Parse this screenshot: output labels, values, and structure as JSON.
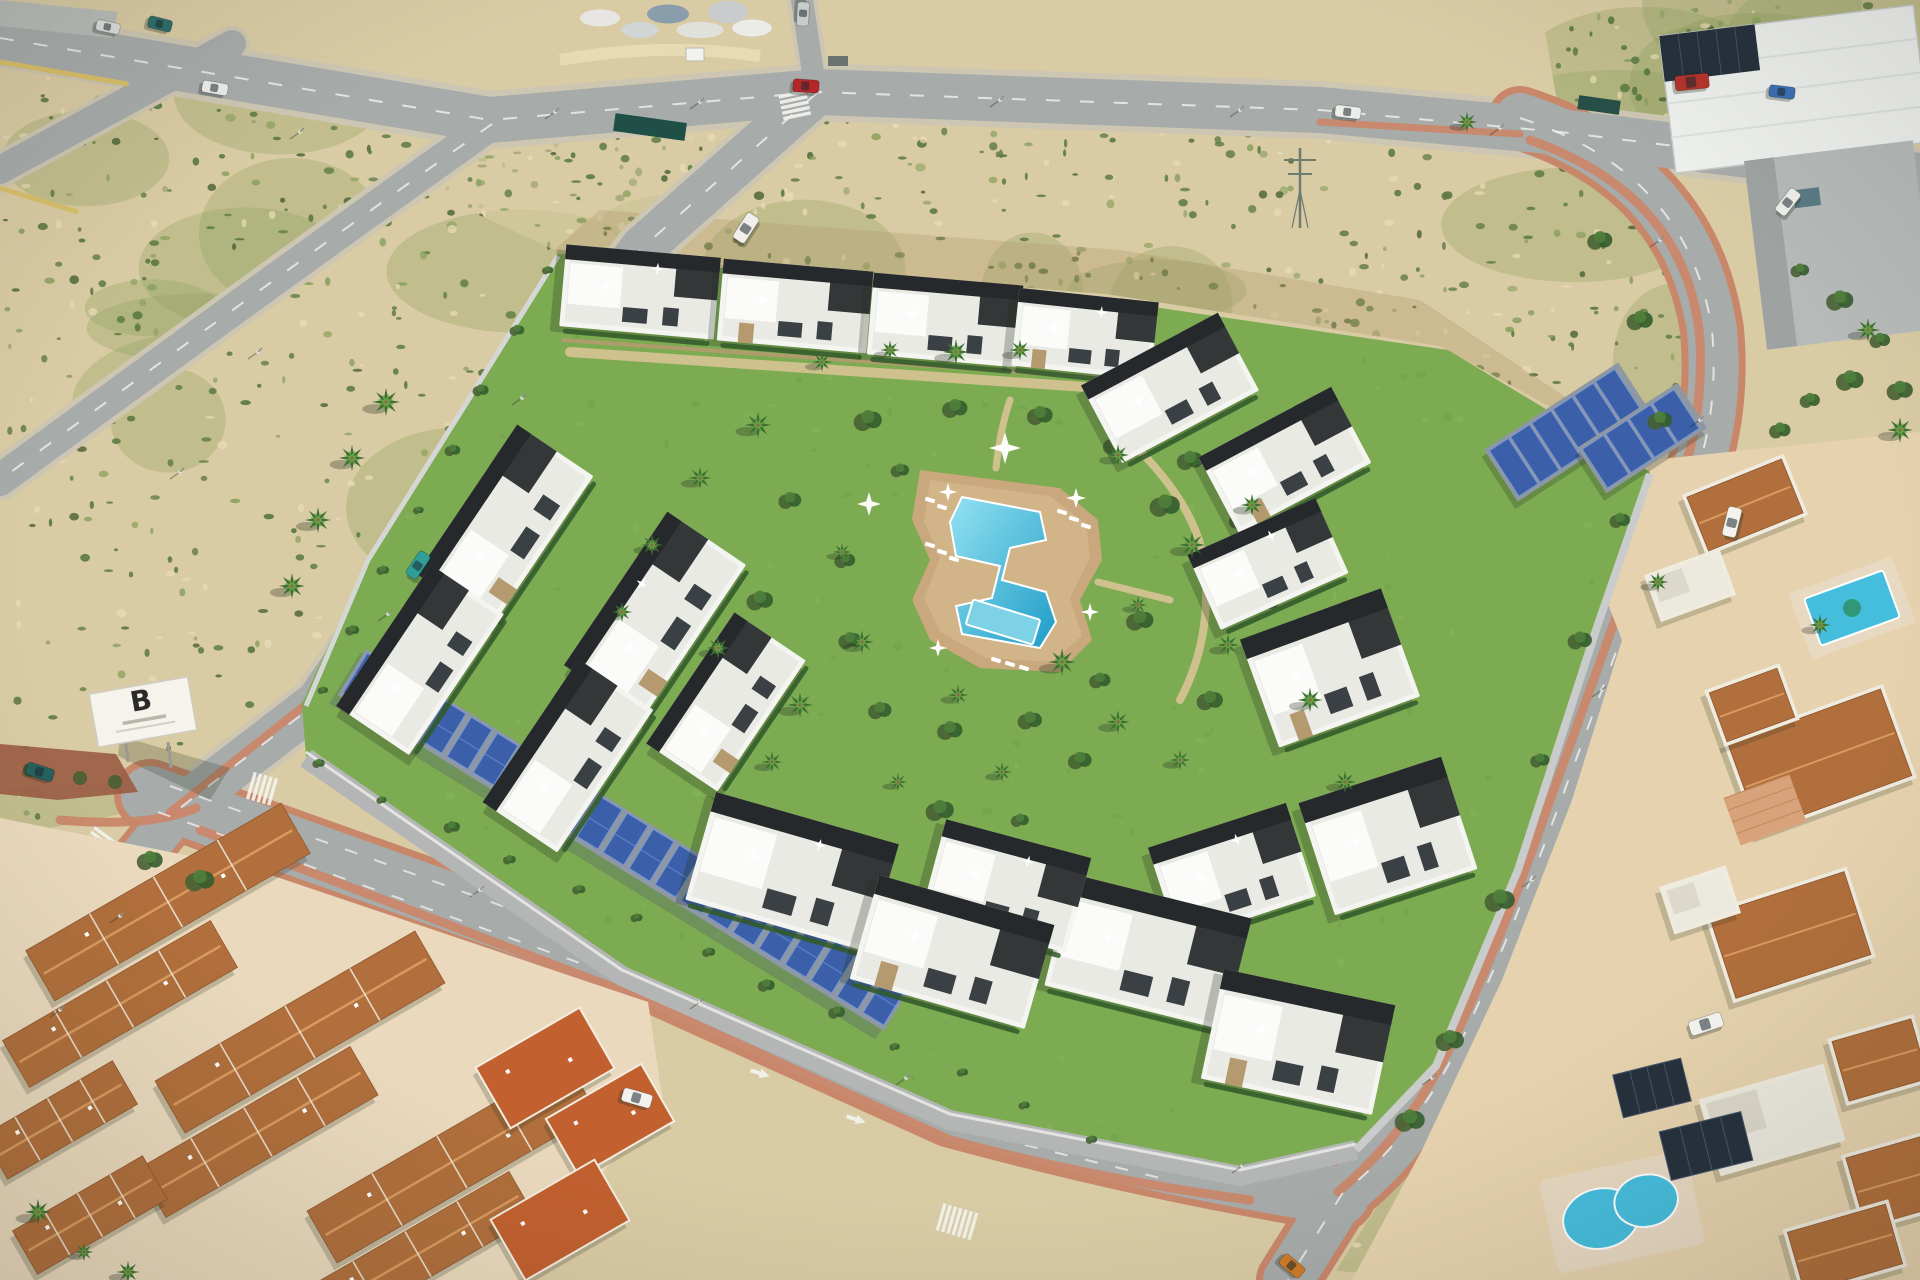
{
  "scene": {
    "description": "Aerial drone render of a modern white residential complex with black roof trims, a communal Z-shaped pool on a lawn with palm trees, long solar-panel carports along the perimeter wall, surrounded by asphalt roads with salmon sidewalks, sandy scrubland plots, a terracotta-roof neighborhood, villas with private pools and an industrial warehouse"
  },
  "billboard": {
    "letter": "B"
  },
  "palette": {
    "sand": "#d9cba4",
    "sandLight": "#e9ddb6",
    "sandDark": "#c3ae85",
    "scrub": "#8aa05e",
    "scrubDark": "#5c7a42",
    "scrubDeep": "#476033",
    "road": "#a7abaa",
    "roadLight": "#b3b7b5",
    "shoulder": "#cdc6b2",
    "pink": "#c9876a",
    "pinkLight": "#dfa483",
    "lawn": "#7cab51",
    "lawnLight": "#93c067",
    "lawnDark": "#699746",
    "poolBlue": "#45bede",
    "poolLight": "#93e2f2",
    "poolDeep": "#1f9cc6",
    "deck": "#c8a87c",
    "deckLight": "#ddc498",
    "white": "#f4f4f0",
    "offwhite": "#e9eae4",
    "roofDark": "#26292b",
    "glass": "#3a4043",
    "stone": "#b59a6f",
    "terra": "#b06f3c",
    "terraLight": "#d89a5f",
    "terraDark": "#8f5730",
    "terraFlat": "#c2602f",
    "solar": "#3b5fa8",
    "solarLight": "#6e93d8",
    "carport": "#8d98a4",
    "hedge": "#335c2c",
    "palm": "#3f7034",
    "palmLight": "#69a445",
    "wall": "#d5d7d4",
    "yellowWall": "#d8c06a",
    "shadow": "#243020",
    "marking": "#f2f2ee",
    "island": "#9a5c42",
    "panelDark": "#26303c"
  },
  "vegetation": {
    "seed": 11,
    "fields": [
      {
        "clip": "clipTopLeft",
        "count": 240,
        "box": [
          0,
          40,
          480,
          430
        ]
      },
      {
        "clip": "clipLeftMid",
        "count": 430,
        "box": [
          0,
          95,
          800,
          745
        ]
      },
      {
        "clip": "clipTopMid",
        "count": 650,
        "box": [
          430,
          90,
          1285,
          380
        ]
      },
      {
        "clip": "clipRightBank",
        "count": 170,
        "box": [
          1330,
          120,
          415,
          1160
        ]
      },
      {
        "clip": "clipTopRight",
        "count": 120,
        "box": [
          1540,
          0,
          380,
          175
        ]
      },
      {
        "clip": "clipLawn",
        "count": 230,
        "box": [
          300,
          250,
          1355,
          930
        ],
        "mode": "lawn"
      }
    ]
  },
  "entities": {
    "buildings": [
      [
        640,
        292,
        155,
        82,
        5
      ],
      [
        795,
        306,
        150,
        82,
        5
      ],
      [
        945,
        320,
        150,
        82,
        5
      ],
      [
        1085,
        334,
        140,
        78,
        6
      ],
      [
        1170,
        388,
        155,
        88,
        -28
      ],
      [
        1285,
        460,
        150,
        86,
        -28
      ],
      [
        1268,
        564,
        140,
        82,
        -24
      ],
      [
        1330,
        668,
        150,
        115,
        -20
      ],
      [
        1388,
        836,
        150,
        118,
        -18
      ],
      [
        1232,
        872,
        145,
        98,
        -18
      ],
      [
        1148,
        952,
        185,
        115,
        14
      ],
      [
        1298,
        1042,
        175,
        112,
        12
      ],
      [
        1006,
        886,
        150,
        98,
        15
      ],
      [
        505,
        525,
        180,
        92,
        -56
      ],
      [
        420,
        660,
        170,
        88,
        -56
      ],
      [
        655,
        615,
        185,
        95,
        -56
      ],
      [
        568,
        756,
        172,
        90,
        -56
      ],
      [
        726,
        702,
        158,
        86,
        -56
      ],
      [
        792,
        872,
        190,
        112,
        16
      ],
      [
        952,
        952,
        182,
        108,
        16
      ]
    ],
    "palms": [
      [
        822,
        362
      ],
      [
        890,
        350
      ],
      [
        956,
        352
      ],
      [
        1020,
        350
      ],
      [
        758,
        425
      ],
      [
        700,
        478
      ],
      [
        652,
        545
      ],
      [
        622,
        612
      ],
      [
        718,
        648
      ],
      [
        800,
        705
      ],
      [
        862,
        642
      ],
      [
        958,
        695
      ],
      [
        1062,
        662
      ],
      [
        1138,
        605
      ],
      [
        1192,
        545
      ],
      [
        1118,
        455
      ],
      [
        842,
        552
      ],
      [
        772,
        762
      ],
      [
        898,
        782
      ],
      [
        1002,
        772
      ],
      [
        1118,
        722
      ],
      [
        1228,
        645
      ],
      [
        1252,
        505
      ],
      [
        1310,
        700
      ],
      [
        1345,
        782
      ],
      [
        1180,
        760
      ],
      [
        318,
        520
      ],
      [
        352,
        458
      ],
      [
        386,
        402
      ],
      [
        292,
        586
      ],
      [
        38,
        1212
      ],
      [
        84,
        1252
      ],
      [
        128,
        1272
      ],
      [
        1467,
        122
      ],
      [
        1658,
        582
      ],
      [
        1820,
        625
      ],
      [
        1868,
        330
      ],
      [
        1900,
        430
      ]
    ],
    "bushes": [
      [
        868,
        420
      ],
      [
        955,
        408
      ],
      [
        1040,
        415
      ],
      [
        1115,
        445
      ],
      [
        1165,
        505
      ],
      [
        900,
        470
      ],
      [
        845,
        560
      ],
      [
        850,
        640
      ],
      [
        880,
        710
      ],
      [
        950,
        730
      ],
      [
        1030,
        720
      ],
      [
        1100,
        680
      ],
      [
        1140,
        620
      ],
      [
        790,
        500
      ],
      [
        760,
        600
      ],
      [
        745,
        680
      ],
      [
        1190,
        460
      ],
      [
        1240,
        520
      ],
      [
        1265,
        600
      ],
      [
        1210,
        700
      ],
      [
        1080,
        760
      ],
      [
        940,
        810
      ],
      [
        1020,
        820
      ],
      [
        1600,
        240
      ],
      [
        1640,
        320
      ],
      [
        1660,
        420
      ],
      [
        1620,
        520
      ],
      [
        1580,
        640
      ],
      [
        1540,
        760
      ],
      [
        1500,
        900
      ],
      [
        1450,
        1040
      ],
      [
        1410,
        1120
      ],
      [
        1800,
        270
      ],
      [
        1840,
        300
      ],
      [
        1880,
        340
      ],
      [
        1850,
        380
      ],
      [
        1810,
        400
      ],
      [
        1780,
        430
      ],
      [
        1900,
        390
      ],
      [
        150,
        860
      ],
      [
        200,
        880
      ]
    ],
    "cars": [
      [
        215,
        88,
        10,
        "#ececec",
        26,
        12
      ],
      [
        160,
        24,
        14,
        "#2e6f6a",
        24,
        12
      ],
      [
        108,
        27,
        12,
        "#dddddd",
        24,
        11
      ],
      [
        418,
        565,
        -56,
        "#2f9e98",
        28,
        13
      ],
      [
        746,
        228,
        -57,
        "#f0efeb",
        30,
        14
      ],
      [
        806,
        86,
        4,
        "#b3272a",
        26,
        13
      ],
      [
        803,
        14,
        93,
        "#c9cccc",
        24,
        12
      ],
      [
        1348,
        112,
        7,
        "#ededea",
        26,
        12
      ],
      [
        1782,
        92,
        7,
        "#3a6fb5",
        26,
        12
      ],
      [
        1732,
        522,
        -76,
        "#f2f2ef",
        30,
        14
      ],
      [
        1788,
        202,
        -52,
        "#eeeeea",
        28,
        13
      ],
      [
        1706,
        1024,
        -18,
        "#f4f4f1",
        34,
        15
      ],
      [
        40,
        772,
        18,
        "#27615d",
        28,
        13
      ],
      [
        637,
        1098,
        16,
        "#f1f1ee",
        30,
        14
      ],
      [
        1292,
        1266,
        40,
        "#d07a28",
        26,
        13
      ],
      [
        1692,
        82,
        -6,
        "#b5342c",
        34,
        15
      ]
    ],
    "crosswalks": [
      [
        795,
        106,
        78,
        5
      ],
      [
        98,
        846,
        -54,
        6
      ],
      [
        263,
        789,
        16,
        5
      ],
      [
        958,
        1222,
        16,
        7
      ],
      [
        1612,
        1204,
        46,
        6
      ]
    ],
    "streetlights": [
      [
        300,
        132
      ],
      [
        555,
        112
      ],
      [
        700,
        102
      ],
      [
        1000,
        100
      ],
      [
        1240,
        110
      ],
      [
        1500,
        128
      ],
      [
        258,
        352
      ],
      [
        180,
        472
      ],
      [
        388,
        614
      ],
      [
        522,
        398
      ],
      [
        906,
        1078
      ],
      [
        700,
        1002
      ],
      [
        480,
        890
      ],
      [
        1242,
        1166
      ],
      [
        1432,
        1078
      ],
      [
        1532,
        880
      ],
      [
        1602,
        690
      ],
      [
        1700,
        420
      ],
      [
        120,
        916
      ],
      [
        60,
        1010
      ],
      [
        1660,
        240
      ]
    ],
    "arrows": [
      [
        762,
        1074,
        18
      ],
      [
        858,
        1120,
        18
      ]
    ]
  }
}
